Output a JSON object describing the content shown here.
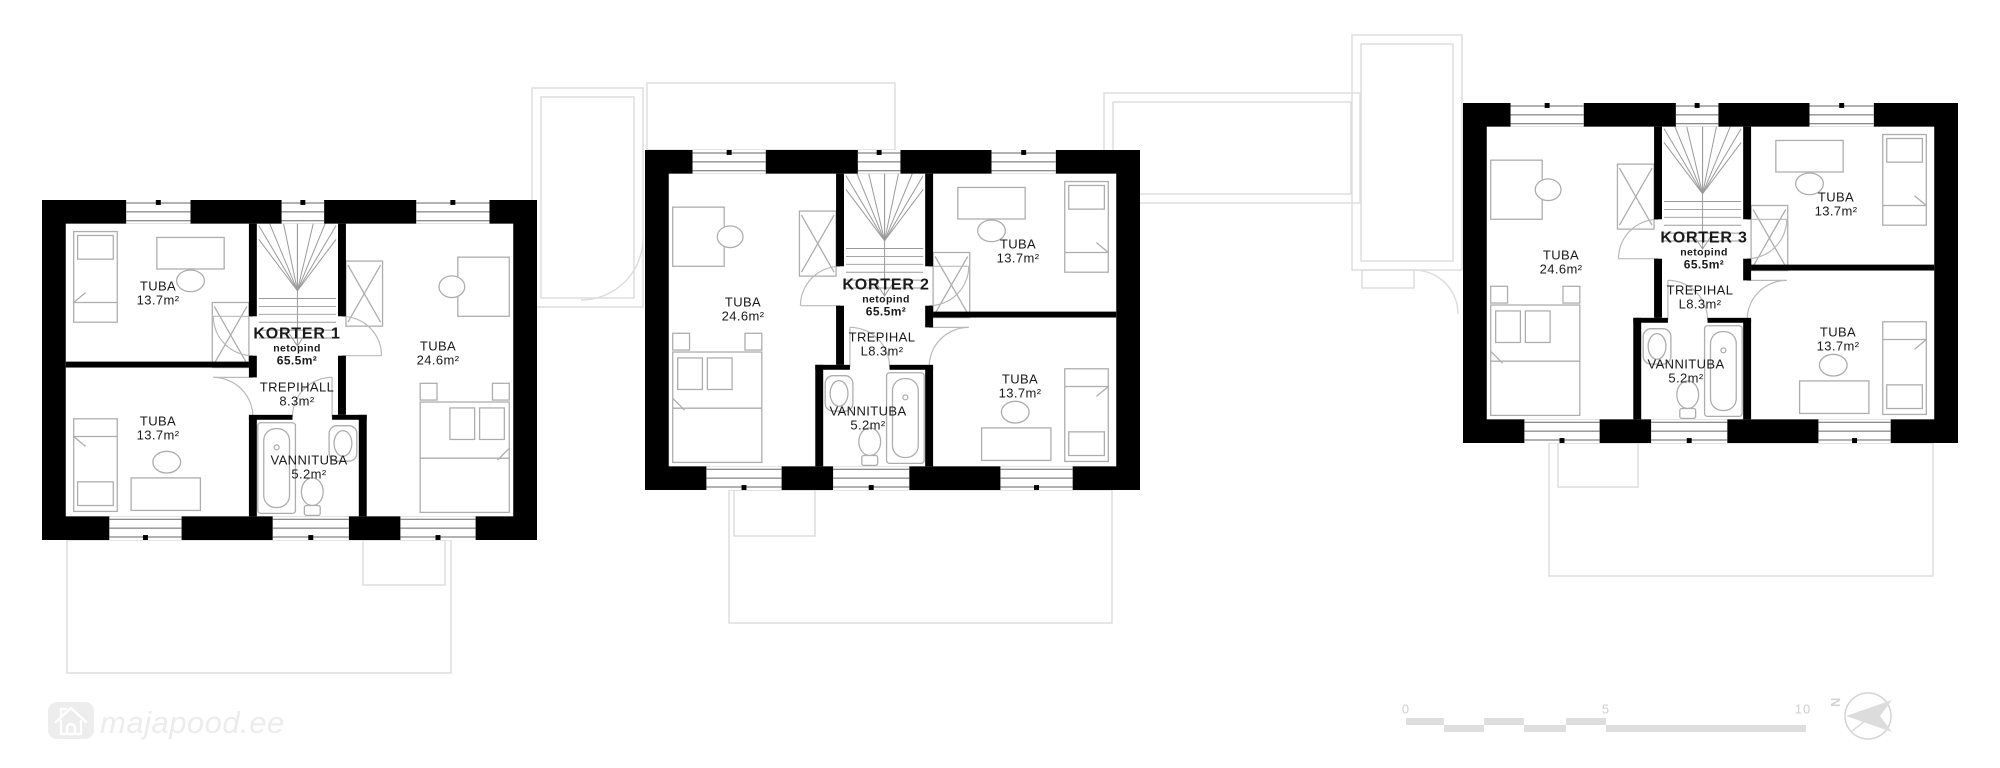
{
  "watermark": {
    "text": "majapood.ee",
    "icon": "house-icon"
  },
  "scale_bar": {
    "labels": [
      "0",
      "5",
      "10"
    ]
  },
  "north_indicator": {
    "letter": "N"
  },
  "colors": {
    "wall": "#000000",
    "furniture_line": "#adadad",
    "door_arc": "#b9b9b9",
    "stair_line": "#9a9a9a",
    "ghost_line": "#dcdcdc",
    "scale_bar": "#dedede",
    "watermark": "#ececec",
    "label_text": "#1a1a1a"
  },
  "units": [
    {
      "title": "KORTER 1",
      "netopind_label": "netopind",
      "net_area": "65.5m²",
      "rooms": {
        "tuba_large": {
          "name": "TUBA",
          "area": "24.6m²"
        },
        "tuba_top": {
          "name": "TUBA",
          "area": "13.7m²"
        },
        "tuba_bottom": {
          "name": "TUBA",
          "area": "13.7m²"
        },
        "trepihall": {
          "line1": "TREPIHALL",
          "line2": "8.3m²"
        },
        "vannituba": {
          "name": "VANNITUBA",
          "area": "5.2m²"
        }
      }
    },
    {
      "title": "KORTER 2",
      "netopind_label": "netopind",
      "net_area": "65.5m²",
      "rooms": {
        "tuba_large": {
          "name": "TUBA",
          "area": "24.6m²"
        },
        "tuba_top": {
          "name": "TUBA",
          "area": "13.7m²"
        },
        "tuba_bottom": {
          "name": "TUBA",
          "area": "13.7m²"
        },
        "trepihall": {
          "line1": "TREPIHAL",
          "line2": "L8.3m²"
        },
        "vannituba": {
          "name": "VANNITUBA",
          "area": "5.2m²"
        }
      }
    },
    {
      "title": "KORTER 3",
      "netopind_label": "netopind",
      "net_area": "65.5m²",
      "rooms": {
        "tuba_large": {
          "name": "TUBA",
          "area": "24.6m²"
        },
        "tuba_top": {
          "name": "TUBA",
          "area": "13.7m²"
        },
        "tuba_bottom": {
          "name": "TUBA",
          "area": "13.7m²"
        },
        "trepihall": {
          "line1": "TREPIHAL",
          "line2": "L8.3m²"
        },
        "vannituba": {
          "name": "VANNITUBA",
          "area": "5.2m²"
        }
      }
    }
  ]
}
